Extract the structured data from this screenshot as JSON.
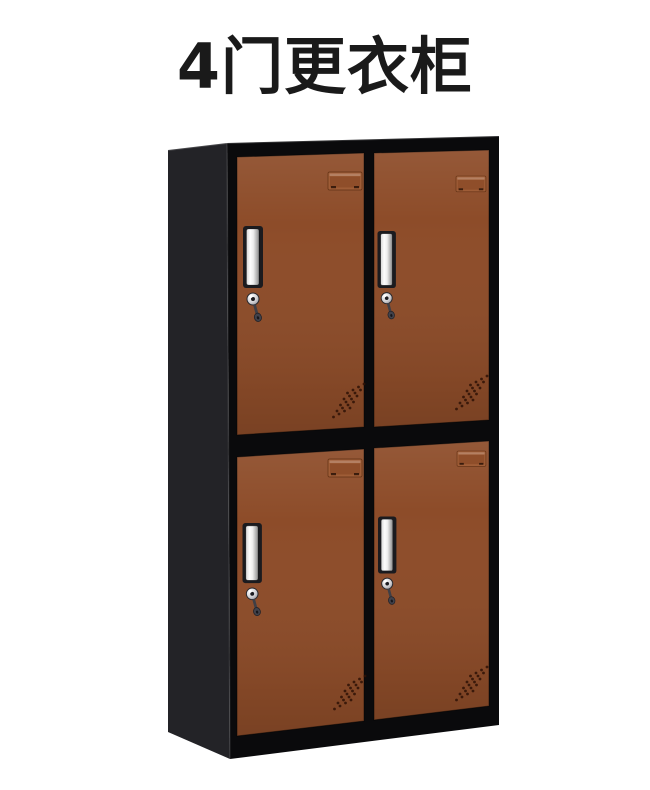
{
  "title": {
    "text": "4门更衣柜"
  },
  "cabinet": {
    "door_count": 4,
    "doors": [
      {
        "position": "top-left",
        "has_handle": true,
        "has_lock_with_key": true,
        "has_label_slot": true,
        "has_vent_holes": true
      },
      {
        "position": "top-right",
        "has_handle": true,
        "has_lock_with_key": true,
        "has_label_slot": true,
        "has_vent_holes": true
      },
      {
        "position": "bottom-left",
        "has_handle": true,
        "has_lock_with_key": true,
        "has_label_slot": true,
        "has_vent_holes": true
      },
      {
        "position": "bottom-right",
        "has_handle": true,
        "has_lock_with_key": true,
        "has_label_slot": true,
        "has_vent_holes": true
      }
    ]
  },
  "colors": {
    "background": "#ffffff",
    "title_text": "#1a1a1a",
    "door": "#8d4c29",
    "frame": "#0a0a0c",
    "side_panel": "#232327",
    "chrome_light": "#fdfdfd",
    "chrome_dark": "#8e8e8e",
    "key_metal": "#3f3f46",
    "vent_hole": "#2e1206",
    "label_slot": "#a05e38"
  }
}
